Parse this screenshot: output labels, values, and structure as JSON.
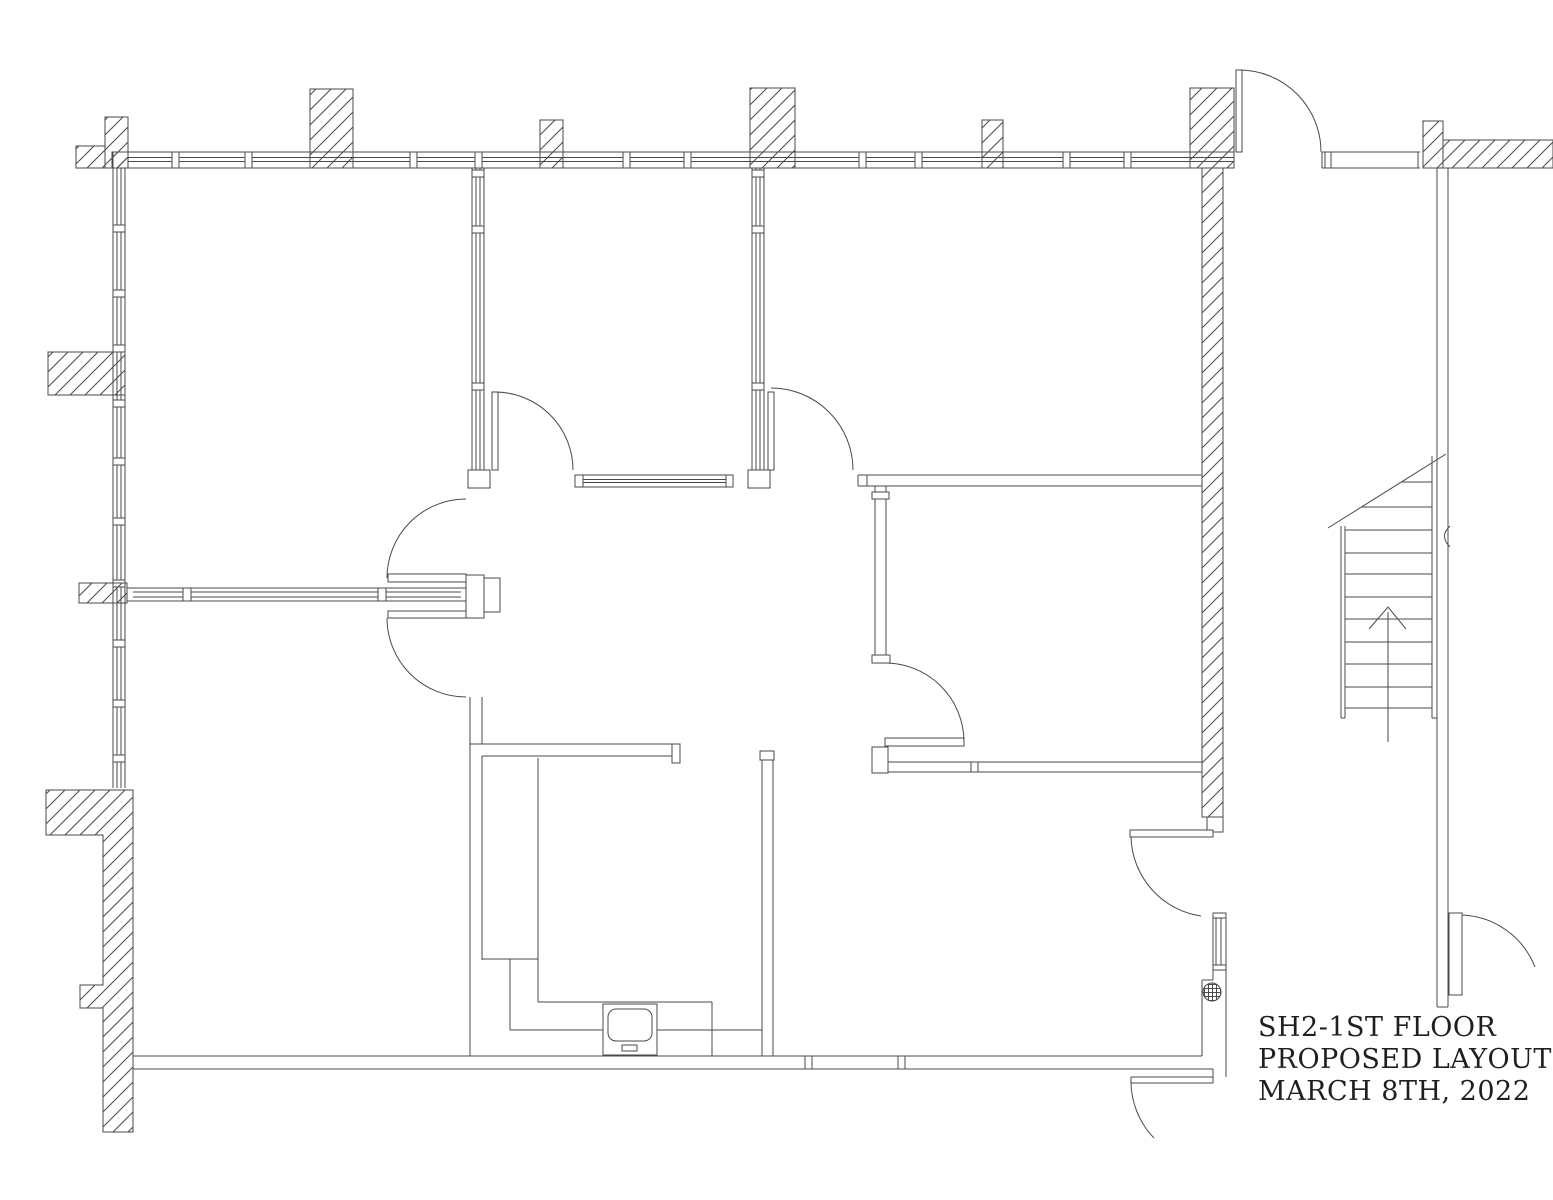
{
  "title_block": {
    "lines": [
      "SH2-1ST FLOOR",
      "PROPOSED LAYOUT",
      "MARCH 8TH, 2022"
    ]
  },
  "colors": {
    "ink": "#4a4a4a",
    "paper": "#ffffff",
    "text": "#1f1f1f"
  },
  "symbols": {
    "stairs": "stairs-with-up-direction-arrow",
    "sink": "wall-mounted-sink",
    "grille": "round-floor-grille",
    "walls": "hatched-masonry-and-window-walls"
  }
}
